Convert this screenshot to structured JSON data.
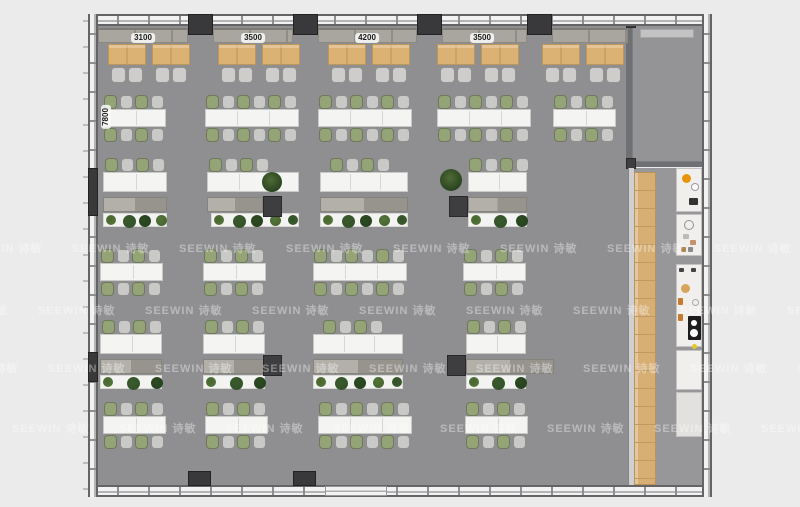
{
  "watermark": {
    "text": "SEEWIN 诗敏"
  },
  "dimensions": {
    "top": [
      {
        "label": "3100",
        "cx": 143,
        "y": 33
      },
      {
        "label": "3500",
        "cx": 253,
        "y": 33
      },
      {
        "label": "4200",
        "cx": 367,
        "y": 33
      },
      {
        "label": "3500",
        "cx": 482,
        "y": 33
      }
    ],
    "left": {
      "label": "7800",
      "cx": 106,
      "cy": 117
    }
  },
  "colors": {
    "bg": "#ebebeb",
    "floor": "#8f8f91",
    "corridor_floor": "#97979a",
    "room_floor": "#949496",
    "room_wall": "#6f7073",
    "divider": "#d0d0d2",
    "chair_gray": "#c9c9c7",
    "chair_green": "#94a477",
    "cafe_chair": "#cecdcb",
    "cabinet_light": "#b3b0aa",
    "cabinet_dark": "#97948e",
    "screen_band": "#c3c3c3",
    "kitchen_unit": "#f0efed",
    "kitchen_unit_low": "#e2e1df",
    "plant_greens": [
      "#54743a",
      "#33522a",
      "#27421f",
      "#48662e",
      "#3a5a2d",
      "#2c4a22"
    ]
  },
  "floorplan": {
    "floor": {
      "x": 98,
      "y": 26,
      "w": 530,
      "h": 459
    },
    "corridor": {
      "x": 628,
      "y": 168,
      "w": 74,
      "h": 317
    },
    "walls": {
      "top": {
        "x": 88,
        "y": 14,
        "w": 624,
        "h": 12
      },
      "bottom": {
        "x": 88,
        "y": 485,
        "w": 624,
        "h": 12
      },
      "left": {
        "x": 88,
        "y": 14,
        "w": 10,
        "h": 483
      },
      "right": {
        "x": 702,
        "y": 14,
        "w": 10,
        "h": 483
      }
    },
    "outer_ticks": {
      "x": 83,
      "y": 20,
      "w": 5,
      "h": 470
    },
    "top_columns": [
      [
        188,
        14,
        25,
        21
      ],
      [
        293,
        14,
        25,
        21
      ],
      [
        417,
        14,
        25,
        21
      ],
      [
        527,
        14,
        25,
        21
      ]
    ],
    "bottom_columns": [
      [
        188,
        471,
        23,
        15
      ],
      [
        293,
        471,
        23,
        15
      ]
    ],
    "left_wall_blocks": [
      [
        88,
        168,
        10,
        48
      ],
      [
        88,
        352,
        10,
        30
      ]
    ],
    "bottom_door": {
      "x": 325,
      "y": 486,
      "w": 62,
      "h": 10
    },
    "bench_segments": [
      [
        98,
        90
      ],
      [
        213,
        80
      ],
      [
        318,
        99
      ],
      [
        442,
        85
      ],
      [
        552,
        76
      ]
    ],
    "bench_y": 28,
    "bench_h": 15,
    "cafe_tables": {
      "y": 44,
      "w": 38,
      "h": 21,
      "chair_y": 67,
      "xs": [
        108,
        152,
        218,
        262,
        328,
        372,
        437,
        481,
        542,
        586
      ]
    },
    "clusters": [
      {
        "x": 103,
        "y": 95,
        "seats": 8
      },
      {
        "x": 205,
        "y": 95,
        "seats": 12
      },
      {
        "x": 318,
        "y": 95,
        "seats": 12
      },
      {
        "x": 437,
        "y": 95,
        "seats": 12
      },
      {
        "x": 553,
        "y": 95,
        "seats": 8
      },
      {
        "x": 100,
        "y": 249,
        "seats": 8
      },
      {
        "x": 203,
        "y": 249,
        "seats": 8
      },
      {
        "x": 313,
        "y": 249,
        "seats": 12
      },
      {
        "x": 463,
        "y": 249,
        "seats": 8
      },
      {
        "x": 103,
        "y": 402,
        "seats": 8
      },
      {
        "x": 205,
        "y": 402,
        "seats": 8
      },
      {
        "x": 318,
        "y": 402,
        "seats": 12
      },
      {
        "x": 465,
        "y": 402,
        "seats": 8
      }
    ],
    "desk_rows": [
      {
        "y": 158,
        "items": [
          {
            "desk": [
              103,
              64
            ],
            "chairs_x": 105,
            "cab": [
              103,
              64
            ],
            "planter": [
              103,
              64
            ]
          },
          {
            "desk": [
              207,
              92
            ],
            "chairs_x": 209,
            "cab": [
              207,
              56
            ],
            "planter": [
              211,
              88
            ]
          },
          {
            "desk": [
              320,
              88
            ],
            "chairs_x": 330,
            "cab": [
              320,
              88
            ],
            "planter": [
              320,
              88
            ]
          },
          {
            "desk": [
              468,
              59
            ],
            "chairs_x": 469,
            "cab": [
              468,
              59
            ],
            "planter": [
              468,
              59
            ]
          }
        ]
      },
      {
        "y": 320,
        "items": [
          {
            "desk": [
              100,
              62
            ],
            "chairs_x": 102,
            "cab": [
              100,
              62
            ],
            "planter": [
              100,
              62
            ]
          },
          {
            "desk": [
              203,
              62
            ],
            "chairs_x": 205,
            "cab": [
              203,
              62
            ],
            "planter": [
              203,
              62
            ]
          },
          {
            "desk": [
              313,
              90
            ],
            "chairs_x": 323,
            "cab": [
              313,
              90
            ],
            "planter": [
              313,
              90
            ]
          },
          {
            "desk": [
              466,
              60
            ],
            "chairs_x": 467,
            "cab": [
              466,
              88
            ],
            "planter": [
              466,
              60
            ]
          }
        ]
      }
    ],
    "pillars": [
      [
        263,
        196,
        19,
        21
      ],
      [
        449,
        196,
        19,
        21
      ],
      [
        263,
        355,
        19,
        21
      ],
      [
        447,
        355,
        19,
        21
      ]
    ],
    "potted_plants": [
      [
        262,
        172,
        20
      ],
      [
        440,
        169,
        22
      ]
    ],
    "room": {
      "x": 626,
      "y": 14,
      "wall": 6,
      "floor": [
        632,
        26,
        70,
        136
      ],
      "bottom_wall": [
        626,
        160,
        78,
        7
      ],
      "screen": [
        640,
        29,
        54,
        9
      ],
      "corners": [
        [
          626,
          14,
          10,
          14
        ],
        [
          626,
          158,
          10,
          11
        ]
      ]
    },
    "wood_walkway": [
      634,
      172,
      22,
      313
    ],
    "divider_wall": [
      628,
      168,
      6,
      317
    ],
    "kitchen_units": [
      {
        "r": [
          676,
          168,
          26,
          44
        ],
        "low": false
      },
      {
        "r": [
          676,
          214,
          26,
          42
        ],
        "low": false
      },
      {
        "r": [
          676,
          264,
          26,
          83
        ],
        "low": false
      },
      {
        "r": [
          676,
          350,
          26,
          40
        ],
        "low": false
      },
      {
        "r": [
          676,
          392,
          26,
          45
        ],
        "low": true
      }
    ],
    "appliances": [
      {
        "r": [
          682,
          174,
          9,
          9
        ],
        "c": "#e8930c",
        "round": true
      },
      {
        "r": [
          691,
          183,
          8,
          8
        ],
        "c": "#ffffff",
        "round": true,
        "bd": "#999"
      },
      {
        "r": [
          689,
          198,
          9,
          7
        ],
        "c": "#333333"
      },
      {
        "r": [
          684,
          220,
          10,
          10
        ],
        "c": "transparent",
        "round": true,
        "bd": "#909090"
      },
      {
        "r": [
          683,
          234,
          6,
          5
        ],
        "c": "#bbbbba"
      },
      {
        "r": [
          690,
          240,
          6,
          5
        ],
        "c": "#c49468"
      },
      {
        "r": [
          681,
          247,
          5,
          5
        ],
        "c": "#b08655"
      },
      {
        "r": [
          688,
          247,
          5,
          5
        ],
        "c": "#8a8a88"
      },
      {
        "r": [
          679,
          268,
          5,
          4
        ],
        "c": "#444444"
      },
      {
        "r": [
          691,
          268,
          5,
          4
        ],
        "c": "#444444"
      },
      {
        "r": [
          681,
          284,
          9,
          9
        ],
        "c": "#d8a35c",
        "round": true
      },
      {
        "r": [
          678,
          298,
          5,
          7
        ],
        "c": "#c77a2a"
      },
      {
        "r": [
          692,
          299,
          7,
          7
        ],
        "c": "#eeeeee",
        "round": true,
        "bd": "#aaa"
      },
      {
        "r": [
          678,
          314,
          5,
          7
        ],
        "c": "#c77a2a"
      },
      {
        "r": [
          688,
          316,
          13,
          24
        ],
        "c": "#1c1c1c"
      },
      {
        "r": [
          691,
          320,
          6,
          6
        ],
        "c": "#ffffff",
        "round": true
      },
      {
        "r": [
          690,
          329,
          8,
          8
        ],
        "c": "#ffffff",
        "round": true
      },
      {
        "r": [
          692,
          344,
          5,
          5
        ],
        "c": "#e6c822",
        "round": true
      }
    ],
    "watermark_rows": [
      {
        "y": 240,
        "x0": 72
      },
      {
        "y": 302,
        "x0": 38
      },
      {
        "y": 360,
        "x0": 48
      },
      {
        "y": 420,
        "x0": 12
      }
    ],
    "watermark_step": 107
  }
}
